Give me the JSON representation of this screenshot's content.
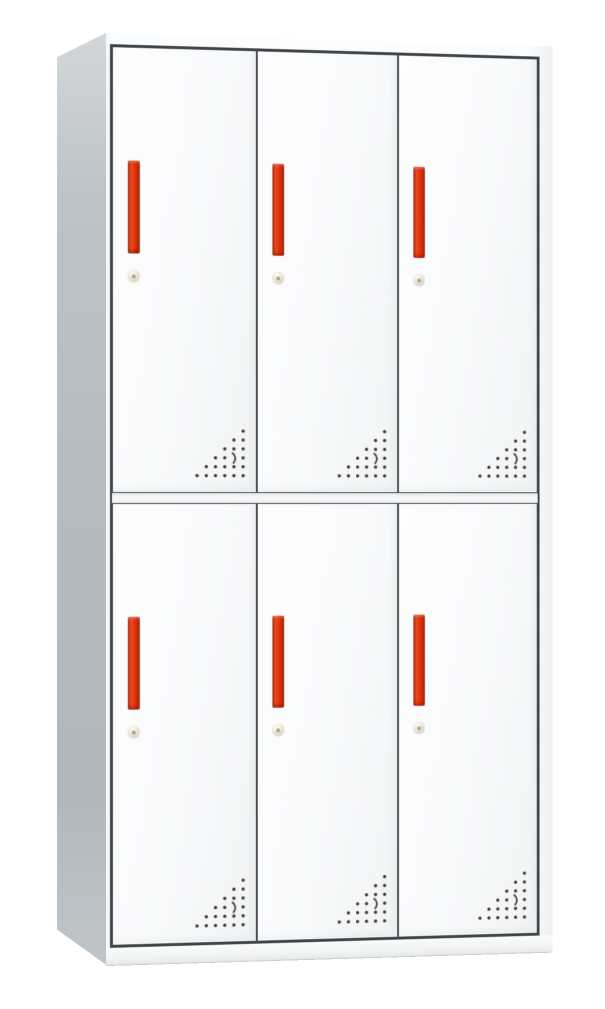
{
  "product": {
    "type": "6-door metal locker cabinet",
    "caption": "White steel locker cabinet with six doors, red recessed handles, round cam locks and triangular ventilation hole patterns",
    "layout": {
      "rows": 2,
      "columns": 3,
      "door_count": 6
    },
    "door_features": {
      "handle": "vertical recessed red pull handle",
      "lock": "round beige cam lock below handle",
      "vents": "triangular grid of perforated ventilation holes in bottom-right corner"
    }
  },
  "colors": {
    "background": "#ffffff",
    "door_face": "#fafbfc",
    "frame_line": "#43474a",
    "side_panel": "#b6bcc0",
    "divider_strip": "#f2f4f5",
    "base": "#f0f2f3",
    "handle_red": "#e0350f",
    "handle_red_dark": "#8f1d05",
    "lock_beige": "#e9e4d2",
    "vent_dot": "#3d3d3d"
  }
}
